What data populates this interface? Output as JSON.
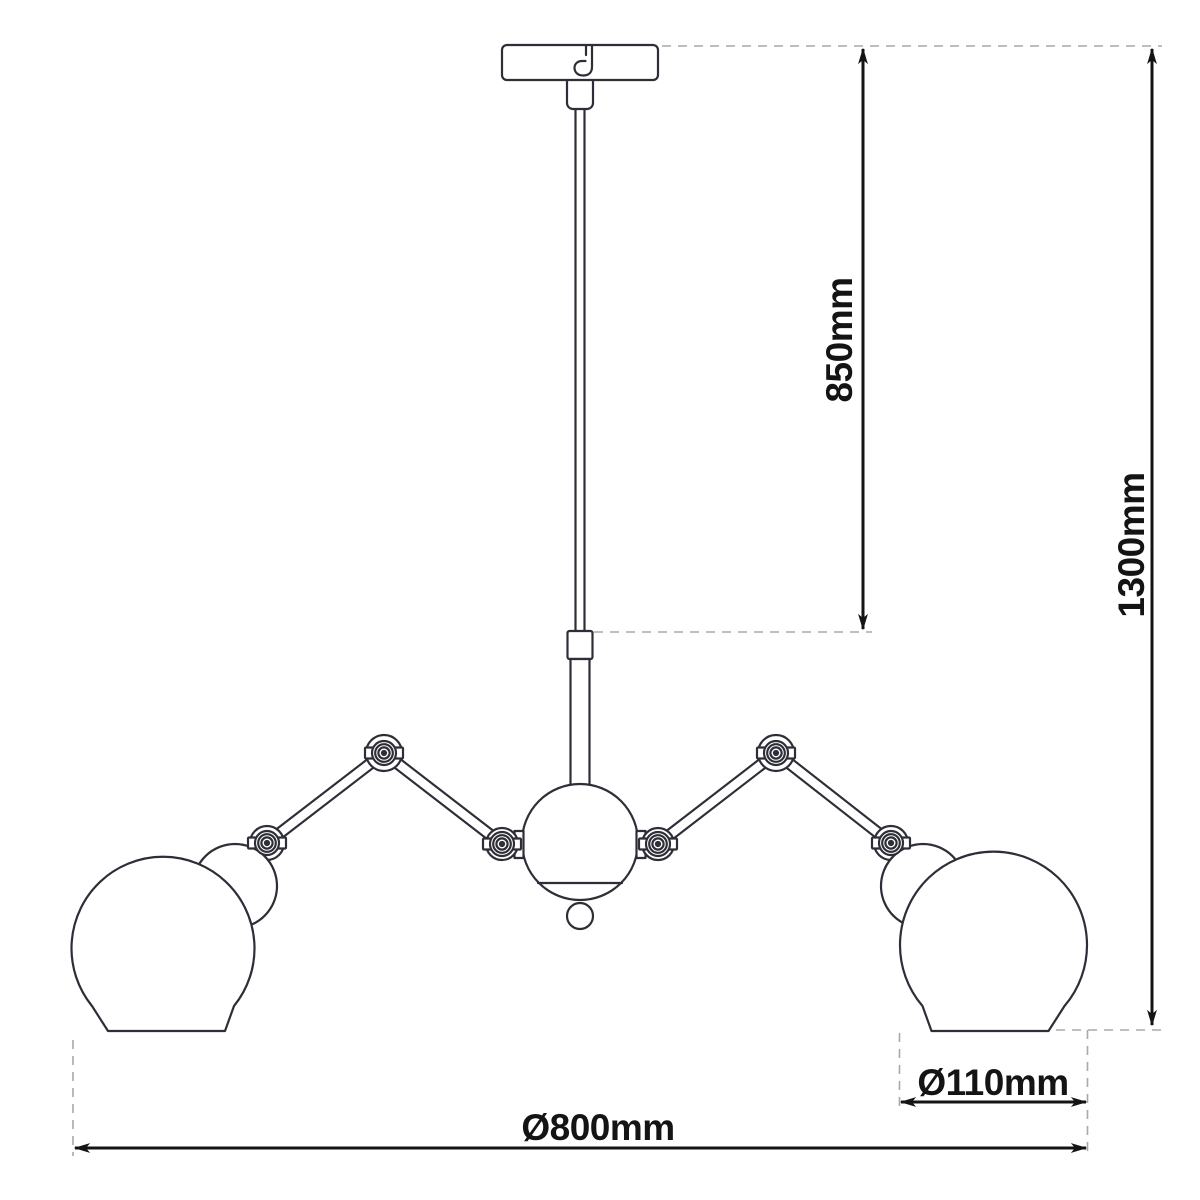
{
  "drawing": {
    "subject": "two-arm adjustable pendant lamp with globe shades",
    "units": "mm",
    "colors": {
      "background": "#ffffff",
      "fixture_outline": "#2e2e38",
      "dimension_line": "#141414",
      "extension_line": "#a8a8a8"
    },
    "dimensions": {
      "rod_drop": {
        "label": "850mm",
        "value": 850,
        "orientation": "vertical"
      },
      "total_drop": {
        "label": "1300mm",
        "value": 1300,
        "orientation": "vertical"
      },
      "shade_diameter": {
        "label": "Ø110mm",
        "value": 110,
        "orientation": "horizontal"
      },
      "fixture_diameter": {
        "label": "Ø800mm",
        "value": 800,
        "orientation": "horizontal"
      }
    }
  }
}
